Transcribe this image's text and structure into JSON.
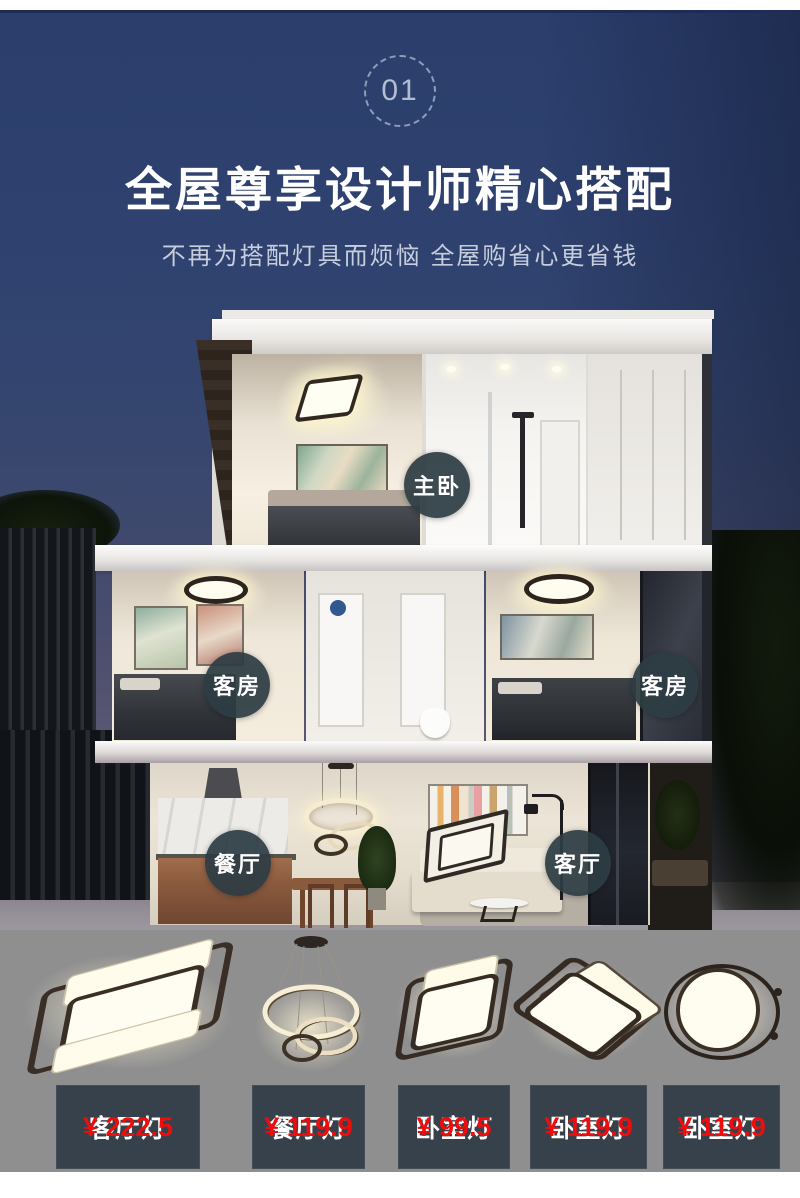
{
  "page": {
    "section_number": "01"
  },
  "header": {
    "title": "全屋尊享设计师精心搭配",
    "subtitle": "不再为搭配灯具而烦恼 全屋购省心更省钱"
  },
  "rooms": [
    {
      "label": "主卧"
    },
    {
      "label": "客房"
    },
    {
      "label": "客房"
    },
    {
      "label": "餐厅"
    },
    {
      "label": "客厅"
    }
  ],
  "products": [
    {
      "name": "客厅灯",
      "price": "¥ 222.5",
      "image": "rect-ceiling-lamp"
    },
    {
      "name": "餐厅灯",
      "price": "¥ 119.9",
      "image": "ring-pendant-lamp"
    },
    {
      "name": "卧室灯",
      "price": "¥ 99.5",
      "image": "square-ceiling-lamp"
    },
    {
      "name": "卧室灯",
      "price": "¥ 119.9",
      "image": "double-square-ceiling-lamp"
    },
    {
      "name": "卧室灯",
      "price": "¥ 119.9",
      "image": "round-ceiling-lamp"
    }
  ],
  "colors": {
    "sky_top": "#2b3e6c",
    "navy_line": "#1d2c55",
    "room_label_bg": "#2d3c44",
    "product_label_bg": "#36414b",
    "price_red": "#ee0d0d",
    "section_gray": "#8f8f8f"
  }
}
